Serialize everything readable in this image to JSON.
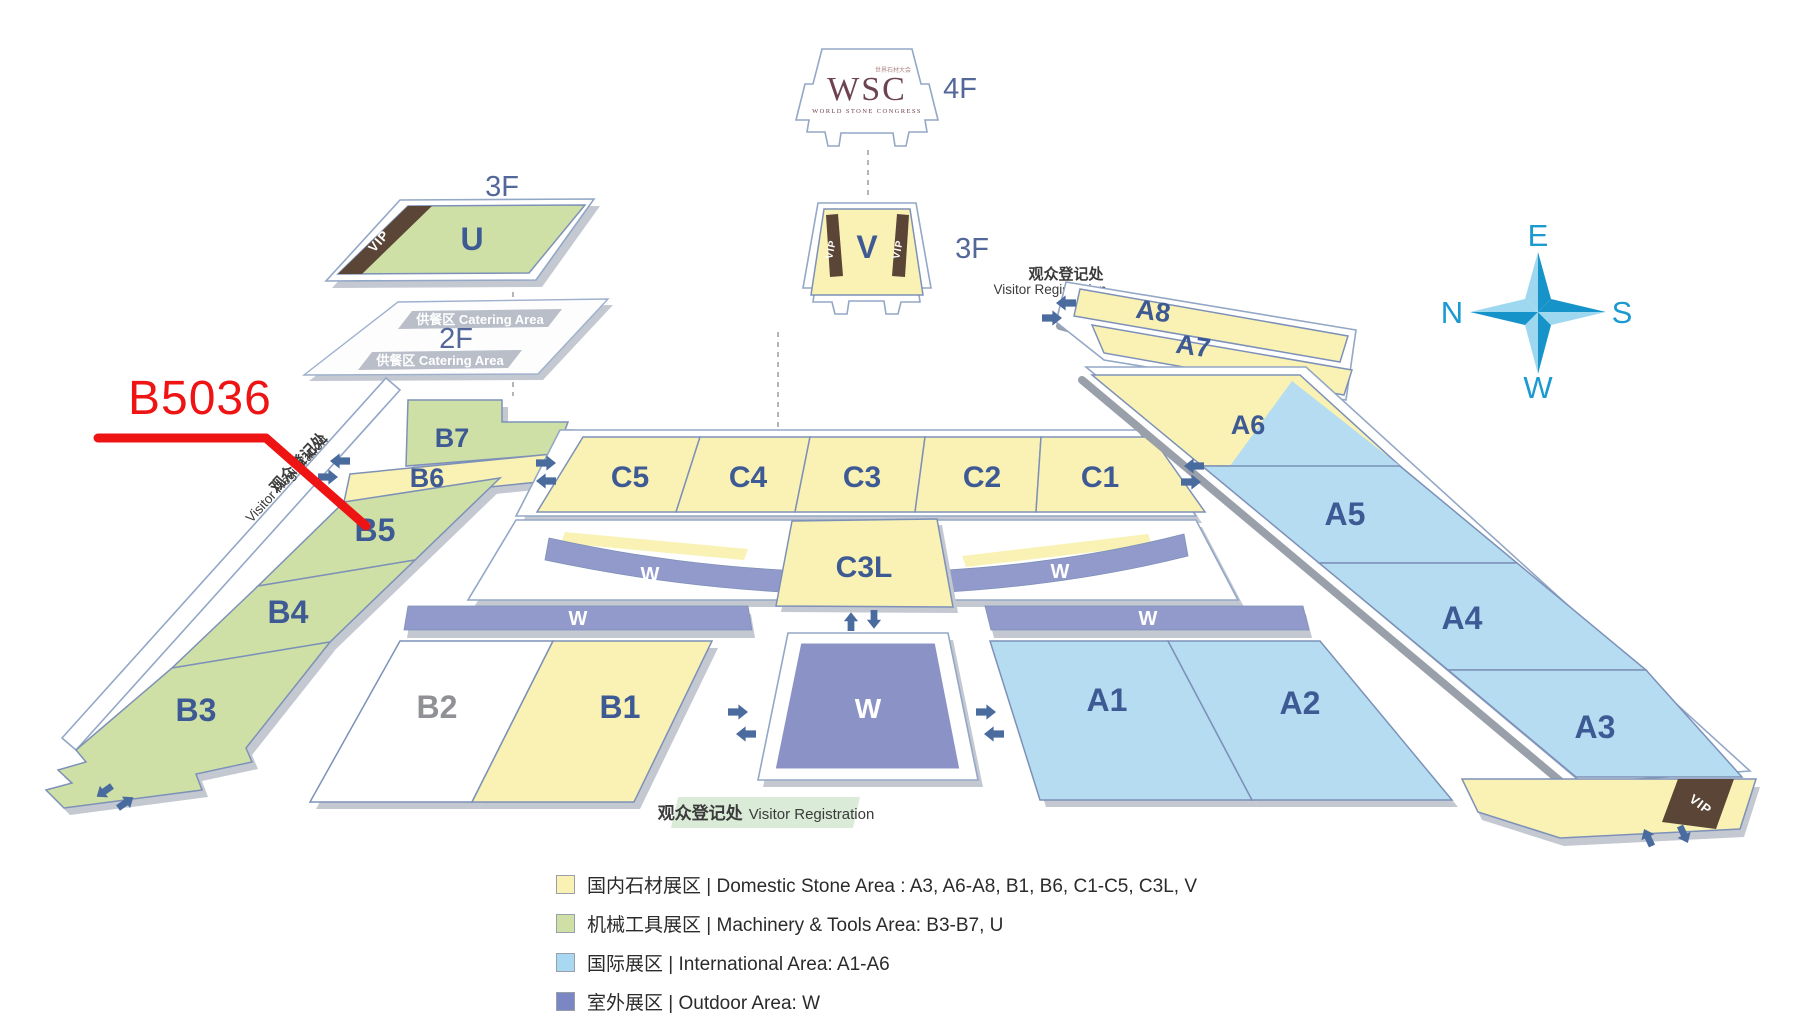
{
  "annotation": {
    "booth_label": "B5036"
  },
  "top_building": {
    "logo": "WSC",
    "logo_sub": "WORLD STONE CONGRESS",
    "logo_cn": "世界石材大会",
    "floor": "4F"
  },
  "v_building": {
    "label": "V",
    "floor": "3F"
  },
  "u_building": {
    "label": "U",
    "floor": "3F"
  },
  "f2": {
    "floor": "2F",
    "catering": "供餐区  Catering Area"
  },
  "registration": {
    "cn": "观众登记处",
    "en": "Visitor Registration"
  },
  "vip": "VIP",
  "halls": {
    "a1": "A1",
    "a2": "A2",
    "a3": "A3",
    "a4": "A4",
    "a5": "A5",
    "a6": "A6",
    "a7": "A7",
    "a8": "A8",
    "b1": "B1",
    "b2": "B2",
    "b3": "B3",
    "b4": "B4",
    "b5": "B5",
    "b6": "B6",
    "b7": "B7",
    "c1": "C1",
    "c2": "C2",
    "c3": "C3",
    "c4": "C4",
    "c5": "C5",
    "c3l": "C3L",
    "w": "W"
  },
  "compass": {
    "top": "E",
    "left": "N",
    "right": "S",
    "bottom": "W"
  },
  "legend": [
    {
      "swatch": "#f9f2b4",
      "text": "国内石材展区 | Domestic Stone Area : A3, A6-A8, B1, B6, C1-C5, C3L, V"
    },
    {
      "swatch": "#cfe0a6",
      "text": "机械工具展区 | Machinery & Tools Area: B3-B7, U"
    },
    {
      "swatch": "#a9d9f2",
      "text": "国际展区 | International Area:  A1-A6"
    },
    {
      "swatch": "#7b87c4",
      "text": "室外展区 | Outdoor Area:  W"
    }
  ],
  "colors": {
    "domestic_yellow": "#f9f2b4",
    "machinery_green": "#cfe0a6",
    "international_blue": "#b5dcf0",
    "outdoor_purple": "#8b93c6",
    "vip_brown": "#5a4536",
    "accent_red": "#ee1414",
    "hall_label_blue": "#3e5a94",
    "floor_label": "#54679a",
    "arrow_blue": "#4a6b9e",
    "compass_dark": "#1693c8",
    "compass_light": "#9ed8f0",
    "registration_band": "#daebd8"
  }
}
